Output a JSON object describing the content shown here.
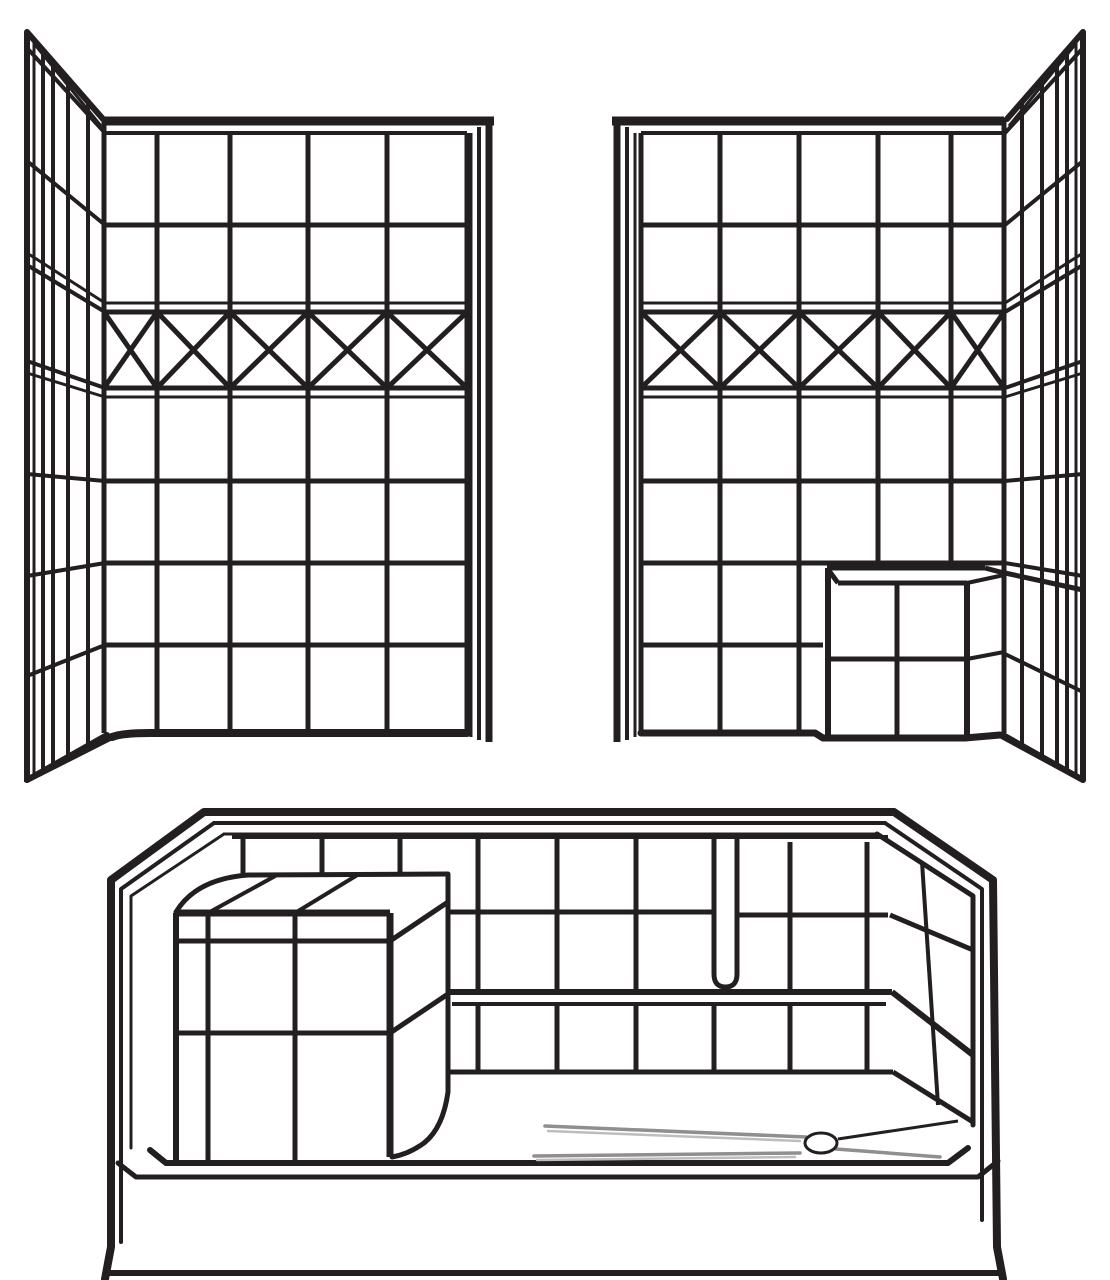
{
  "figure": {
    "type": "technical-line-drawing",
    "subject": "Three-piece barrier-free tiled shower system",
    "background_color": "#ffffff",
    "line_color": "#231f20",
    "slope_line_color": "#8f8f8f",
    "components": [
      {
        "id": "left-wall-panel",
        "label": "Left tiled shower wall panel with corner return and diamond accent band"
      },
      {
        "id": "right-wall-panel",
        "label": "Right tiled shower wall panel with corner return, diamond accent band and corner seat"
      },
      {
        "id": "shower-base",
        "label": "Shower base pan with molded seat, tiled back wall, transfer step and drain"
      },
      {
        "id": "drain",
        "label": "Shower drain with sloped floor lines"
      }
    ]
  }
}
